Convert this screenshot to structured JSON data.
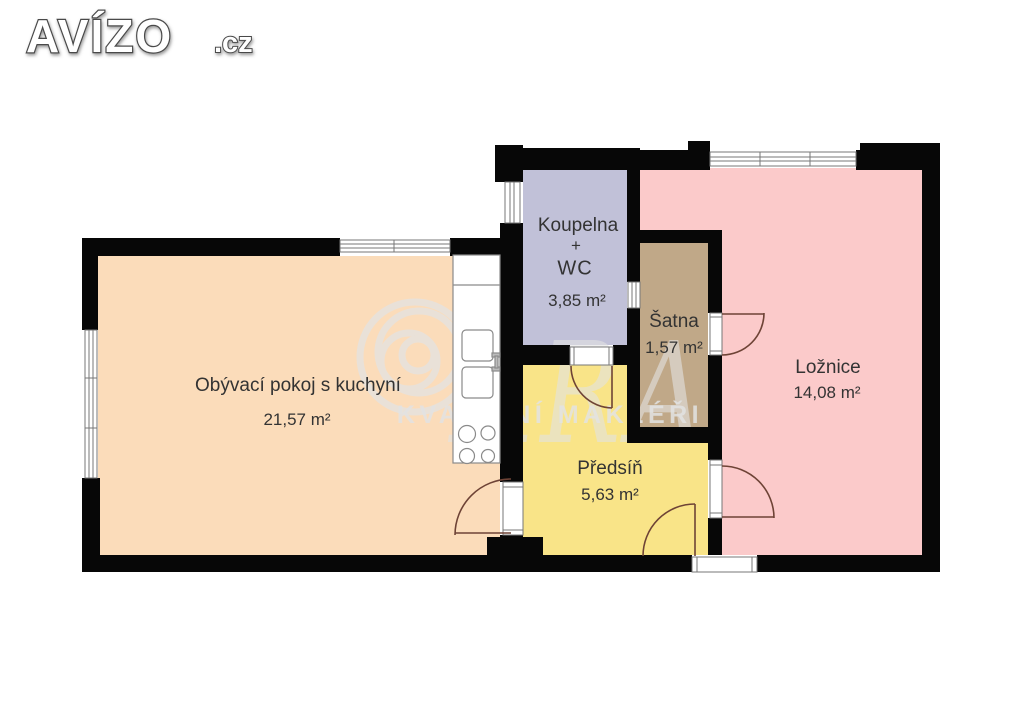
{
  "site": {
    "logo_text": "AVÍZO",
    "logo_suffix": ".cz"
  },
  "watermark": {
    "brand_letters": "ARA",
    "tagline": "KVALITNÍ MAKLÉŘI",
    "color": "#e3e3e3"
  },
  "plan": {
    "wall_color": "#070707",
    "door_arc_color": "#6e4336",
    "fixture_line_color": "#8a8a8a"
  },
  "rooms": [
    {
      "id": "living-room",
      "name": "Obývací pokoj s kuchyní",
      "area": "21,57 m²",
      "color": "#fbdcba"
    },
    {
      "id": "bathroom",
      "name": "Koupelna",
      "name2": "+",
      "name3": "WC",
      "area": "3,85 m²",
      "color": "#c1c1d8"
    },
    {
      "id": "closet",
      "name": "Šatna",
      "area": "1,57 m²",
      "color": "#c0a888"
    },
    {
      "id": "bedroom",
      "name": "Ložnice",
      "area": "14,08 m²",
      "color": "#fbcaca"
    },
    {
      "id": "hallway",
      "name": "Předsíň",
      "area": "5,63 m²",
      "color": "#f9e488"
    }
  ]
}
